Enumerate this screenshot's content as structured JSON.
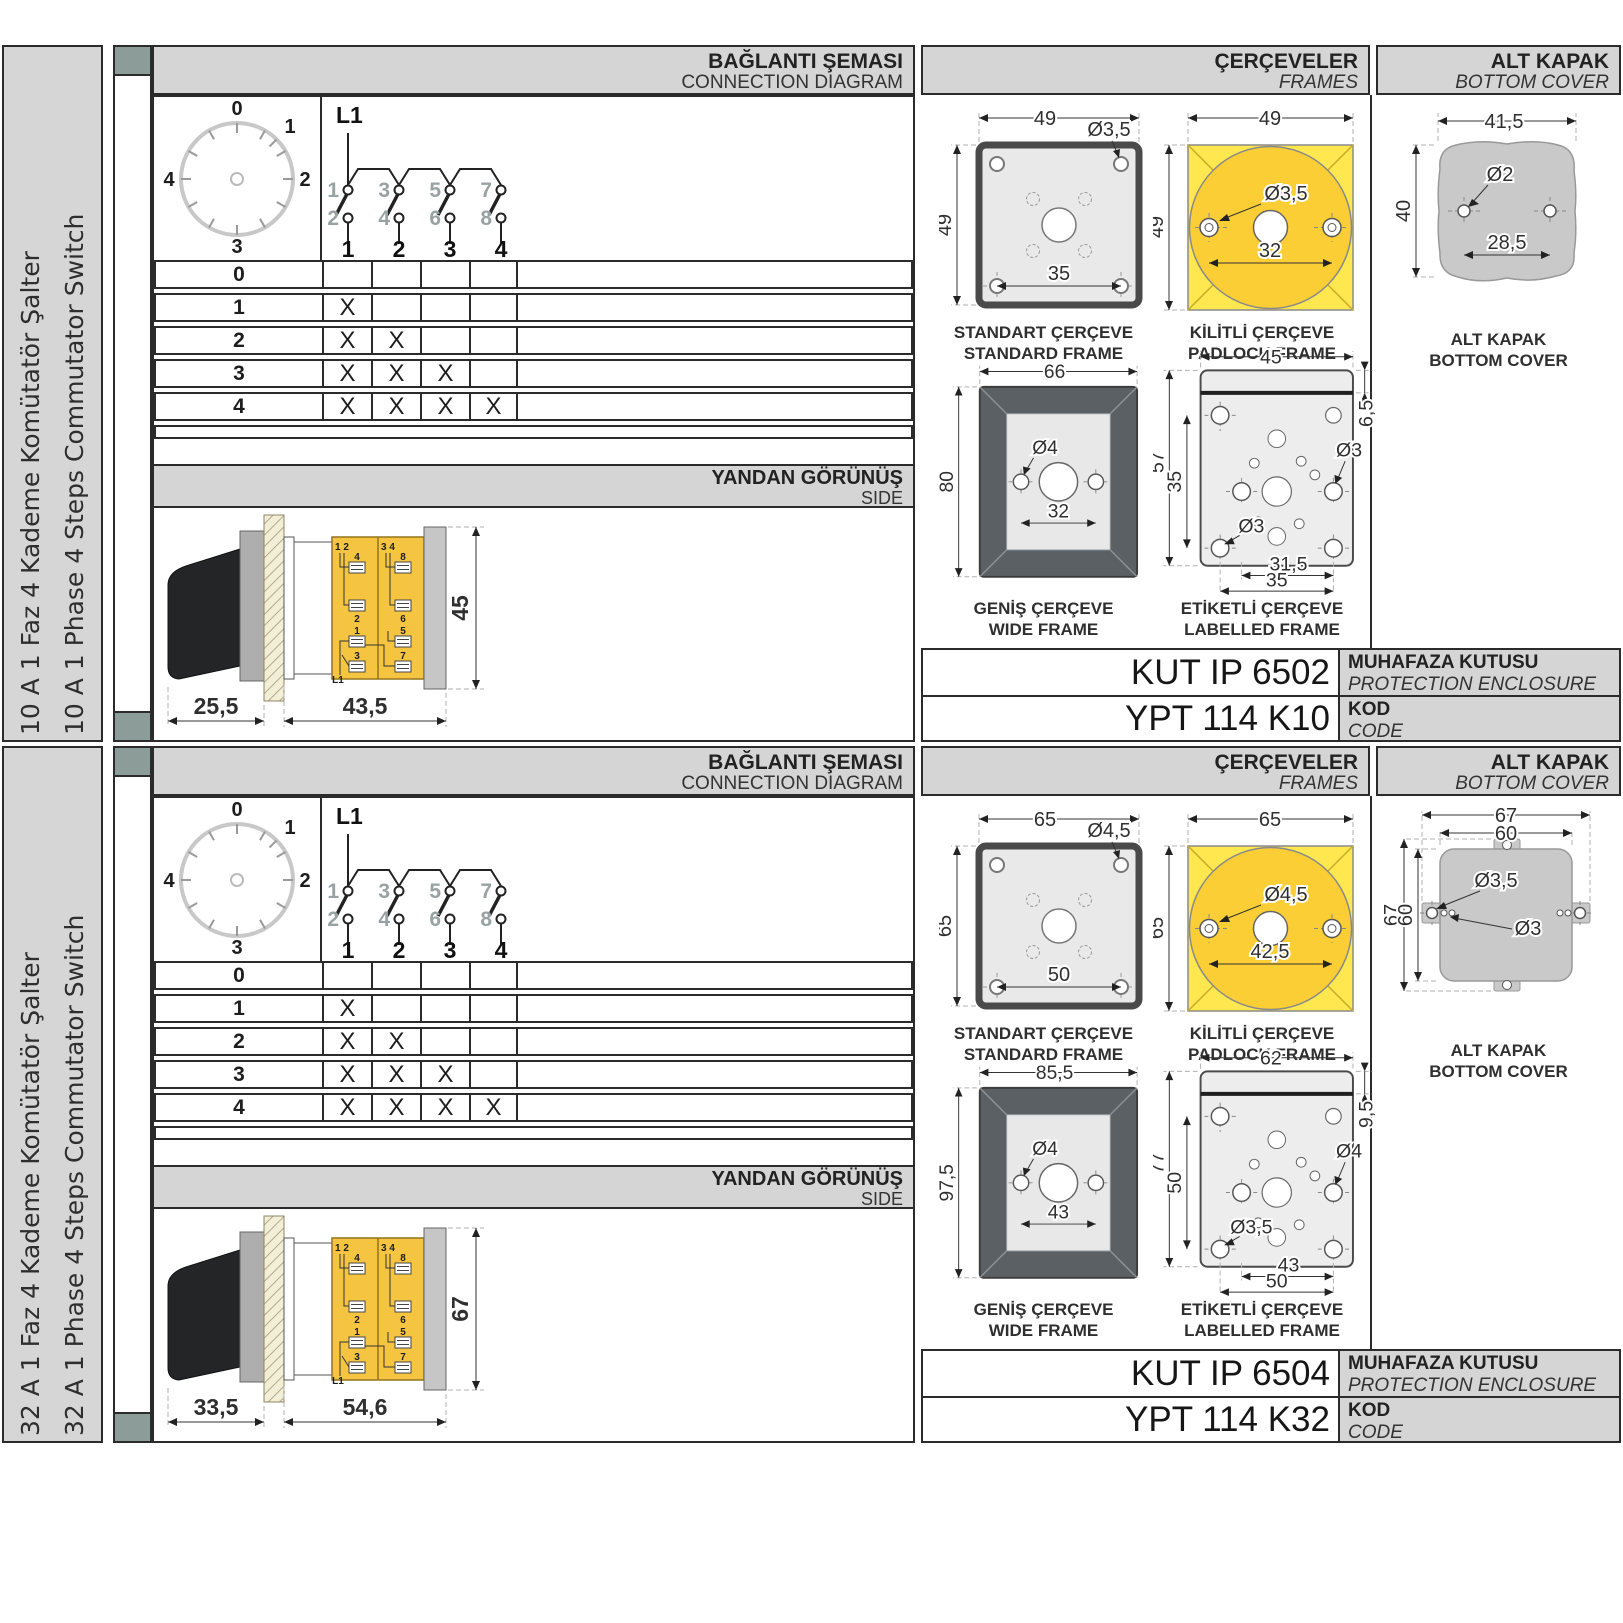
{
  "labels": {
    "conn_tr": "BAĞLANTI ŞEMASI",
    "conn_en": "CONNECTION DIAGRAM",
    "frames_tr": "ÇERÇEVELER",
    "frames_en": "FRAMES",
    "cover_tr": "ALT KAPAK",
    "cover_en": "BOTTOM COVER",
    "side_tr": "YANDAN GÖRÜNÜŞ",
    "side_en": "SIDE",
    "std_tr": "STANDART ÇERÇEVE",
    "std_en": "STANDARD FRAME",
    "pad_tr": "KİLİTLİ ÇERÇEVE",
    "pad_en": "PADLOCK FRAME",
    "wide_tr": "GENİŞ ÇERÇEVE",
    "wide_en": "WIDE FRAME",
    "lbl_tr": "ETİKETLİ ÇERÇEVE",
    "lbl_en": "LABELLED FRAME",
    "encl_tr": "MUHAFAZA KUTUSU",
    "encl_en": "PROTECTION ENCLOSURE",
    "kod_tr": "KOD",
    "kod_en": "CODE",
    "mark": "X",
    "l1": "L1"
  },
  "diagram": {
    "positions": [
      "0",
      "1",
      "2",
      "3",
      "4"
    ],
    "top_contacts": [
      "1",
      "3",
      "5",
      "7"
    ],
    "bottom_contacts": [
      "2",
      "4",
      "6",
      "8"
    ],
    "poles": [
      "1",
      "2",
      "3",
      "4"
    ]
  },
  "side_terms": {
    "tl": "1 2",
    "tr": "3 4",
    "a4": "4",
    "a8": "8",
    "a2": "2",
    "a6": "6",
    "b1": "1",
    "b5": "5",
    "b3": "3",
    "b7": "7"
  },
  "sections": [
    {
      "title_tr": "10 A 1 Faz 4 Kademe Komütatör Şalter",
      "title_en": "10 A 1 Phase 4 Steps Commutator Switch",
      "enclosure_code": "KUT IP 6502",
      "code": "YPT 114 K10",
      "std": {
        "w": "49",
        "h": "49",
        "dia": "Ø3,5",
        "pitch": "35"
      },
      "pad": {
        "w": "49",
        "h": "49",
        "dia": "Ø3,5",
        "pitch": "32"
      },
      "wide": {
        "w": "66",
        "h": "80",
        "dia": "Ø4",
        "pitch": "32"
      },
      "lbl": {
        "w": "45",
        "band": "6,5",
        "h": "57",
        "ih": "35",
        "dia_r": "Ø3",
        "dia_l": "Ø3",
        "p1": "31,5",
        "p2": "35"
      },
      "cover": {
        "w": "41,5",
        "h": "40",
        "dia": "Ø2",
        "pitch": "28,5"
      },
      "side": {
        "a": "25,5",
        "b": "43,5",
        "h": "45"
      }
    },
    {
      "title_tr": "32 A 1 Faz 4 Kademe Komütatör Şalter",
      "title_en": "32 A 1 Phase 4 Steps Commutator Switch",
      "enclosure_code": "KUT IP 6504",
      "code": "YPT 114 K32",
      "std": {
        "w": "65",
        "h": "65",
        "dia": "Ø4,5",
        "pitch": "50"
      },
      "pad": {
        "w": "65",
        "h": "65",
        "dia": "Ø4,5",
        "pitch": "42,5"
      },
      "wide": {
        "w": "85,5",
        "h": "97,5",
        "dia": "Ø4",
        "pitch": "43"
      },
      "lbl": {
        "w": "62",
        "band": "9,5",
        "h": "77",
        "ih": "50",
        "dia_r": "Ø4",
        "dia_l": "Ø3,5",
        "p1": "43",
        "p2": "50"
      },
      "cover": {
        "ow": "67",
        "iw": "60",
        "dia": "Ø3,5",
        "dia2": "Ø3",
        "oh": "67",
        "ih": "60"
      },
      "side": {
        "a": "33,5",
        "b": "54,6",
        "h": "67"
      }
    }
  ]
}
